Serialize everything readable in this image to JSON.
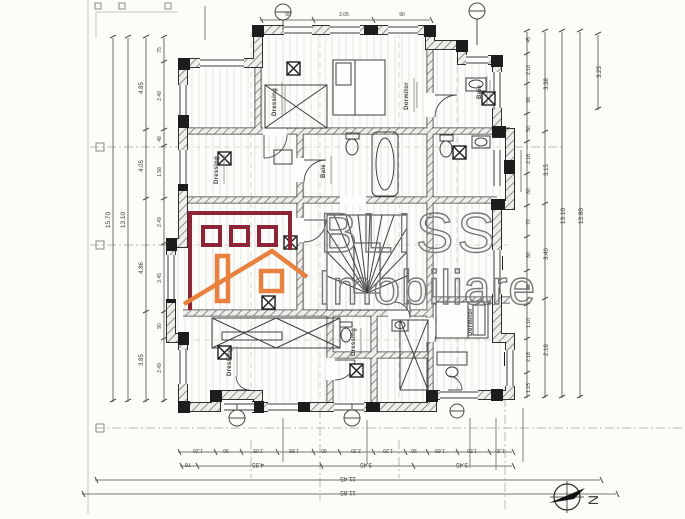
{
  "watermark": {
    "brand": "BLISS",
    "brand_sub": "Imobiliare"
  },
  "compass": {
    "north_label": "N"
  },
  "rooms": {
    "top_left": "Dressing",
    "top_center": "Dormitor",
    "top_right": "Baie",
    "mid_left": "Dressing",
    "mid_center": "Baie",
    "bottom_left": "Dressing",
    "bottom_center": "Dressing",
    "bottom_right": "Dormitor"
  },
  "dims": {
    "left_total": "15.70",
    "left_sub": "13.10",
    "left_chain": [
      "4.85",
      "4.05",
      "4.86",
      "3.85"
    ],
    "left_detail": [
      "75",
      "2.48",
      "48",
      "1.98",
      "2.49",
      "3.45",
      "90",
      "2.49"
    ],
    "right_detail": [
      "45",
      "2.10",
      "90",
      "50",
      "2.16",
      "60",
      "70",
      "80",
      "1.28",
      "1.10",
      "2.18",
      "1.15"
    ],
    "right_chain": [
      "3.38",
      "3.15",
      "3.40",
      "2.16"
    ],
    "right_sub": "13.10",
    "right_total": "13.80",
    "right_top": "3.23",
    "bottom_detail": [
      "1.20",
      "90",
      "2.05",
      "1.65",
      "90",
      "2.30",
      "1.20",
      "90",
      "1.65",
      "1.50",
      "1.30"
    ],
    "bottom_chain": [
      "78",
      "4.35",
      "3.45",
      "3.45"
    ],
    "bottom_sub": "11.45",
    "bottom_total": "11.85",
    "top_detail": [
      "90",
      "2.05",
      "90"
    ]
  },
  "colors": {
    "logo_red": "#8e2438",
    "logo_orange": "#e8813e",
    "watermark_gray": "#787878"
  }
}
